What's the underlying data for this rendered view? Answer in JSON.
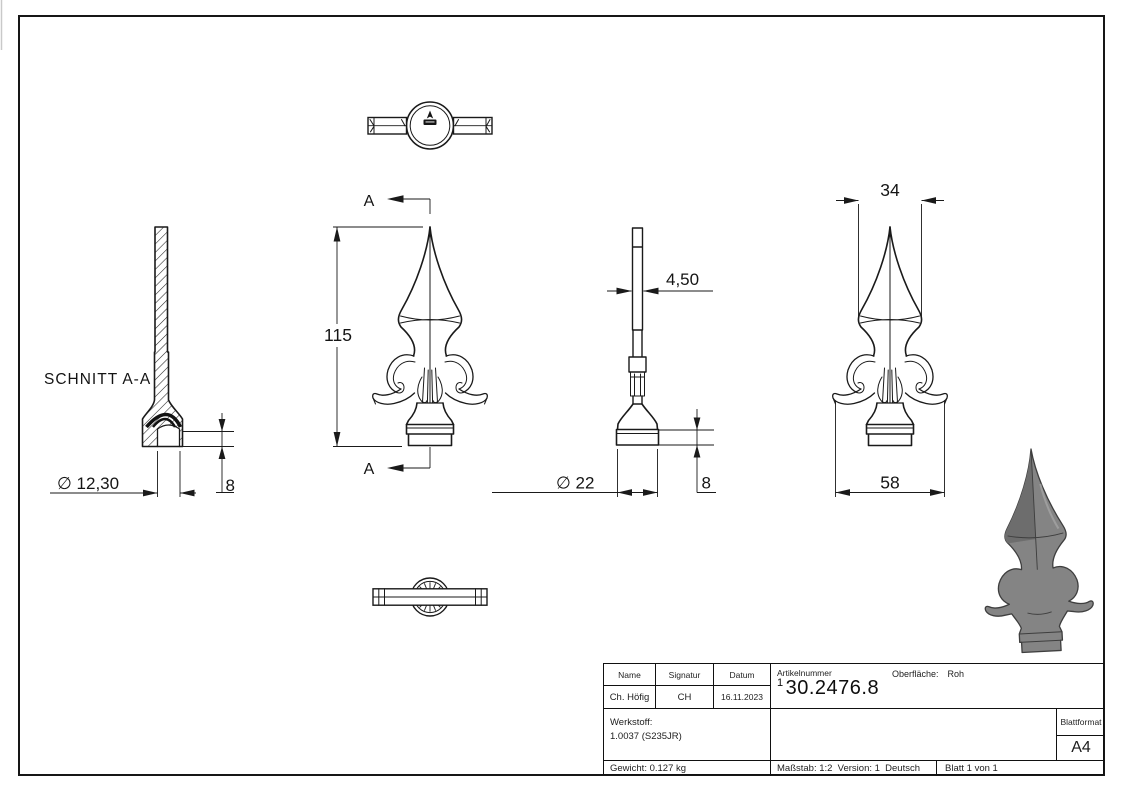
{
  "colors": {
    "line": "#1a1a1a",
    "render_gray": "#848484",
    "render_dark": "#6d6d6d"
  },
  "views": {
    "top_view": {
      "icon": "brand-mark-icon"
    },
    "section_view": {
      "label": "SCHNITT A-A",
      "dim_diameter": "∅ 12,30",
      "dim_height": "8"
    },
    "front_view": {
      "dim_height": "115",
      "section_mark_top": "A",
      "section_mark_bottom": "A"
    },
    "side_view": {
      "dim_thickness": "4,50",
      "dim_diameter": "∅ 22",
      "dim_collar": "8"
    },
    "rotated_view": {
      "dim_blade_width": "34",
      "dim_leaf_width": "58"
    }
  },
  "title_block": {
    "name_label": "Name",
    "signature_label": "Signatur",
    "date_label": "Datum",
    "name_value": "Ch. Höfig",
    "signature_value": "CH",
    "date_value": "16.11.2023",
    "article_label": "Artikelnummer",
    "article_sup": "1",
    "article_value": "30.2476.8",
    "surface_label": "Oberfläche:",
    "surface_value": "Roh",
    "material_label": "Werkstoff:",
    "material_value": "1.0037 (S235JR)",
    "weight": "Gewicht: 0.127 kg",
    "scale": "Maßstab: 1:2",
    "version": "Version: 1",
    "language": "Deutsch",
    "sheet": "Blatt 1 von 1",
    "sheet_format_label": "Blattformat",
    "sheet_format_value": "A4"
  }
}
